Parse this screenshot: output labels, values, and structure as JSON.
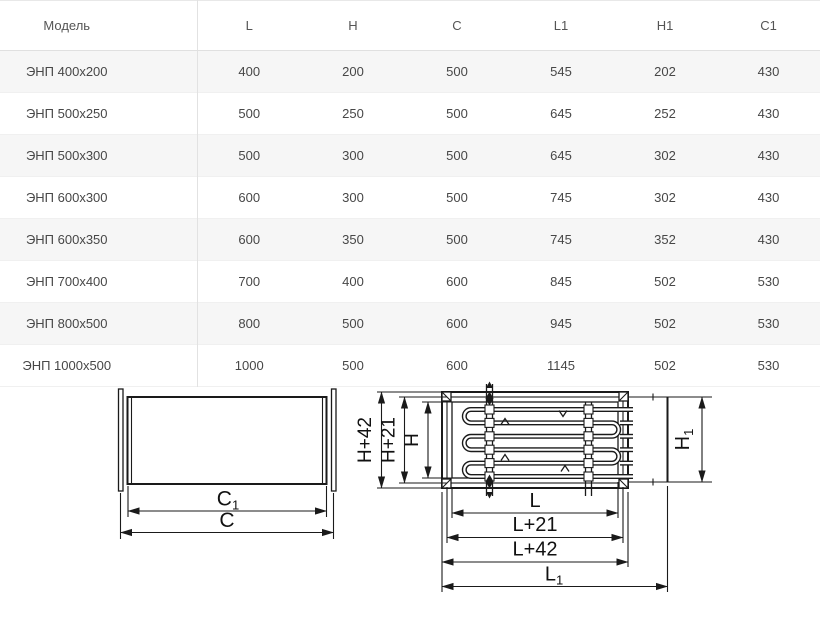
{
  "table": {
    "columns": [
      "Модель",
      "L",
      "H",
      "C",
      "L1",
      "H1",
      "C1"
    ],
    "rows": [
      {
        "model": "ЭНП 400x200",
        "values": [
          "400",
          "200",
          "500",
          "545",
          "202",
          "430"
        ]
      },
      {
        "model": "ЭНП 500x250",
        "values": [
          "500",
          "250",
          "500",
          "645",
          "252",
          "430"
        ]
      },
      {
        "model": "ЭНП 500x300",
        "values": [
          "500",
          "300",
          "500",
          "645",
          "302",
          "430"
        ]
      },
      {
        "model": "ЭНП 600x300",
        "values": [
          "600",
          "300",
          "500",
          "745",
          "302",
          "430"
        ]
      },
      {
        "model": "ЭНП 600x350",
        "values": [
          "600",
          "350",
          "500",
          "745",
          "352",
          "430"
        ]
      },
      {
        "model": "ЭНП 700x400",
        "values": [
          "700",
          "400",
          "600",
          "845",
          "502",
          "530"
        ]
      },
      {
        "model": "ЭНП 800x500",
        "values": [
          "800",
          "500",
          "600",
          "945",
          "502",
          "530"
        ]
      },
      {
        "model": "ЭНП 1000x500",
        "values": [
          "1000",
          "500",
          "600",
          "1145",
          "502",
          "530"
        ]
      }
    ]
  },
  "drawings": {
    "side_view": {
      "dim_c1_base": "C",
      "dim_c1_sub": "1",
      "dim_c": "C"
    },
    "front_view": {
      "dim_h42": "H+42",
      "dim_h21": "H+21",
      "dim_h": "H",
      "dim_h1_base": "H",
      "dim_h1_sub": "1",
      "dim_l": "L",
      "dim_l21": "L+21",
      "dim_l42": "L+42",
      "dim_l1_base": "L",
      "dim_l1_sub": "1"
    }
  },
  "colors": {
    "row_stripe": "#f6f6f6",
    "table_border": "#e2e2e2",
    "table_text": "#474747",
    "drawing_line": "#1a1a1a"
  }
}
